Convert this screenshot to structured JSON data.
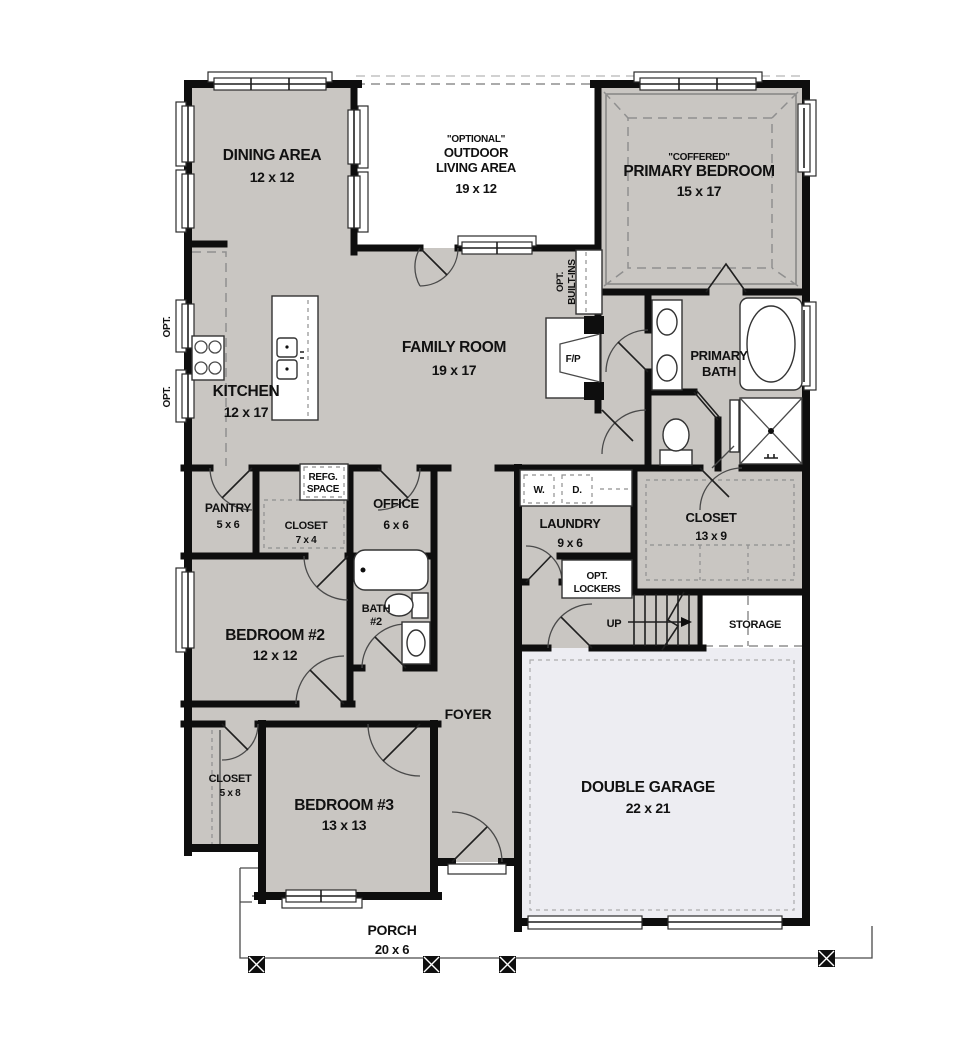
{
  "colors": {
    "floor_gray": "#c9c6c2",
    "garage_floor": "#ededf2",
    "wall_black": "#0e0e0e",
    "background": "#ffffff"
  },
  "rooms": {
    "dining": {
      "name": "DINING AREA",
      "dims": "12 x 12"
    },
    "outdoor": {
      "tag": "\"OPTIONAL\"",
      "line1": "OUTDOOR",
      "line2": "LIVING AREA",
      "dims": "19 x 12"
    },
    "primary_bedroom": {
      "tag": "\"COFFERED\"",
      "name": "PRIMARY BEDROOM",
      "dims": "15 x 17"
    },
    "family": {
      "name": "FAMILY ROOM",
      "dims": "19 x 17"
    },
    "kitchen": {
      "name": "KITCHEN",
      "dims": "12 x 17"
    },
    "primary_bath": {
      "line1": "PRIMARY",
      "line2": "BATH"
    },
    "pantry": {
      "name": "PANTRY",
      "dims": "5 x 6"
    },
    "refg": {
      "line1": "REFG.",
      "line2": "SPACE"
    },
    "closet_7x4": {
      "name": "CLOSET",
      "dims": "7 x 4"
    },
    "office": {
      "name": "OFFICE",
      "dims": "6 x 6"
    },
    "laundry": {
      "name": "LAUNDRY",
      "dims": "9 x 6"
    },
    "washer": "W.",
    "dryer": "D.",
    "lockers": {
      "line1": "OPT.",
      "line2": "LOCKERS"
    },
    "closet_13x9": {
      "name": "CLOSET",
      "dims": "13 x 9"
    },
    "bath2": {
      "line1": "BATH",
      "line2": "#2"
    },
    "bedroom2": {
      "name": "BEDROOM #2",
      "dims": "12 x 12"
    },
    "stairs_up": "UP",
    "storage": "STORAGE",
    "foyer": "FOYER",
    "closet_5x8": {
      "name": "CLOSET",
      "dims": "5 x 8"
    },
    "bedroom3": {
      "name": "BEDROOM #3",
      "dims": "13 x 13"
    },
    "garage": {
      "name": "DOUBLE GARAGE",
      "dims": "22 x 21"
    },
    "porch": {
      "name": "PORCH",
      "dims": "20 x 6"
    }
  },
  "annotations": {
    "fireplace": "F/P",
    "opt_builtins_line1": "OPT.",
    "opt_builtins_line2": "BUILT-INS",
    "opt_window_1": "OPT.",
    "opt_window_2": "OPT."
  }
}
